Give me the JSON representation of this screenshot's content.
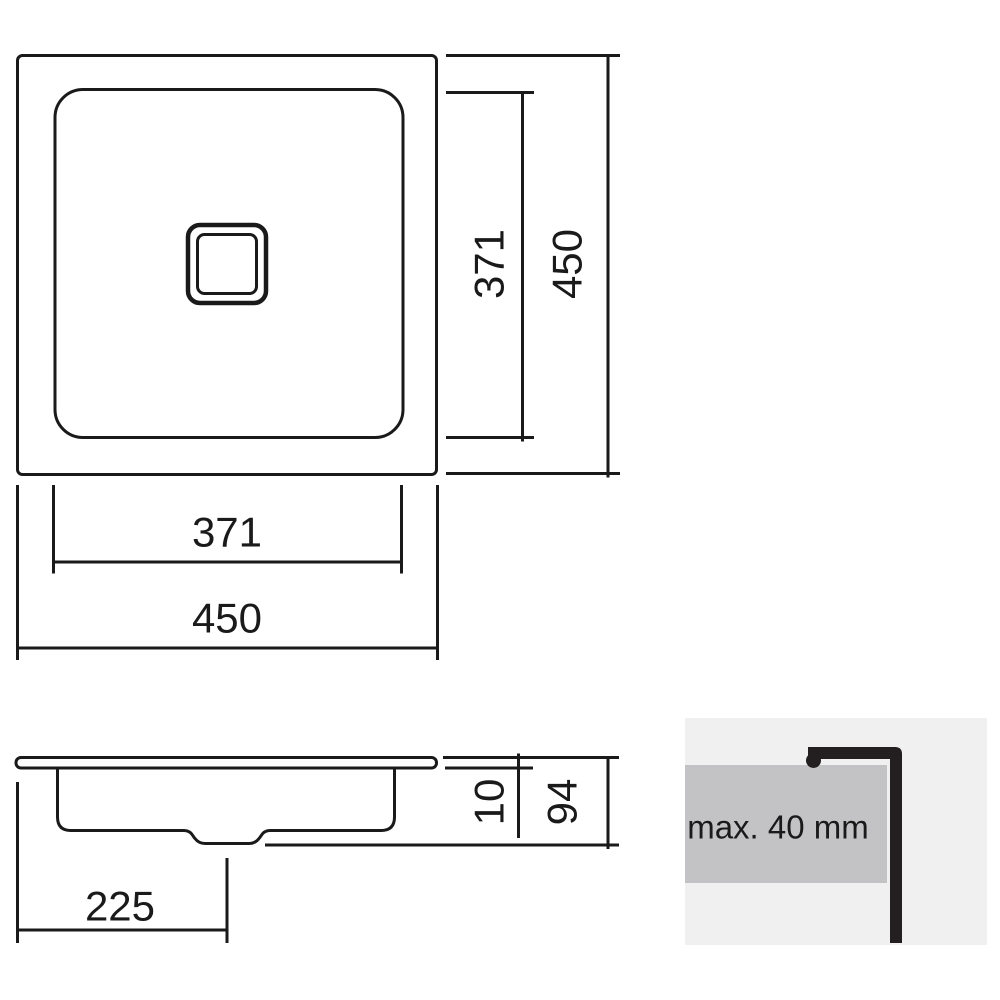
{
  "drawing": {
    "top_view": {
      "outer_height_label": "450",
      "inner_height_label": "371",
      "outer_width_label": "450",
      "inner_width_label": "371"
    },
    "section_view": {
      "drain_offset_label": "225",
      "rim_height_label": "10",
      "depth_label": "94"
    },
    "installation_detail": {
      "countertop_thickness_label": "max. 40 mm"
    },
    "colors": {
      "line": "#1a1a1a",
      "detail_panel_bg": "#f0f0f1",
      "countertop_fill": "#c3c3c5",
      "profile_fill": "#231f20"
    }
  }
}
